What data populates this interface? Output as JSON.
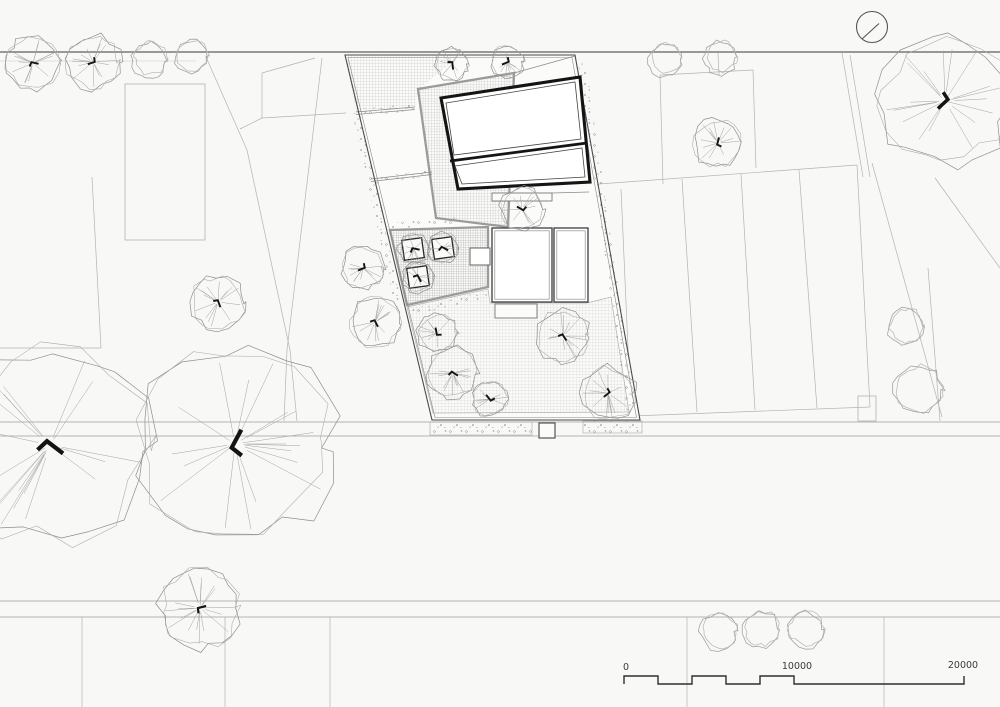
{
  "drawing": {
    "type": "architectural-site-plan"
  },
  "colors": {
    "background": "#f8f8f6",
    "road_dark": "#5f5f5f",
    "road_light": "#9f9f9f",
    "context_line": "#b3b3b3",
    "boundary": "#4a4a4a",
    "building_wall": "#141414",
    "gray_border": "#9b9b9b",
    "speckle": "#8c8c8c",
    "tree_outline": "#8f8f8f",
    "tree_spoke": "#a2a2a2",
    "trunk": "#141414",
    "scale": "#2f2f2f"
  },
  "roads": [
    [
      0,
      52,
      1000,
      52,
      1.3,
      "#5f5f5f"
    ],
    [
      0,
      61,
      196,
      61,
      0.6,
      "#c6c6c6"
    ],
    [
      0,
      422,
      1000,
      422,
      0.8,
      "#9f9f9f"
    ],
    [
      0,
      436,
      1000,
      436,
      0.8,
      "#9f9f9f"
    ],
    [
      0,
      601,
      1000,
      601,
      0.8,
      "#9f9f9f"
    ],
    [
      0,
      617,
      1000,
      617,
      0.8,
      "#9f9f9f"
    ]
  ],
  "context": {
    "rects": [
      [
        125,
        84,
        80,
        156
      ],
      [
        858,
        396,
        18,
        25
      ]
    ],
    "segments": [
      [
        315,
        58,
        262,
        73
      ],
      [
        262,
        73,
        262,
        118
      ],
      [
        262,
        118,
        240,
        129
      ],
      [
        262,
        118,
        346,
        113
      ],
      [
        206,
        57,
        247,
        150
      ],
      [
        247,
        150,
        290,
        350
      ],
      [
        290,
        350,
        297,
        421
      ],
      [
        322,
        58,
        287,
        350
      ],
      [
        287,
        350,
        284,
        421
      ],
      [
        92,
        177,
        101,
        348
      ],
      [
        0,
        348,
        101,
        348
      ],
      [
        82,
        617,
        82,
        707
      ],
      [
        225,
        617,
        225,
        707
      ],
      [
        330,
        617,
        330,
        707
      ],
      [
        687,
        617,
        687,
        707
      ],
      [
        884,
        617,
        884,
        707
      ],
      [
        599,
        184,
        857,
        165
      ],
      [
        857,
        165,
        870,
        407
      ],
      [
        631,
        416,
        870,
        407
      ],
      [
        621,
        189,
        631,
        416
      ],
      [
        682,
        179,
        697,
        412
      ],
      [
        741,
        174,
        755,
        410
      ],
      [
        799,
        170,
        817,
        408
      ],
      [
        660,
        75,
        753,
        70
      ],
      [
        660,
        75,
        663,
        184
      ],
      [
        753,
        70,
        756,
        168
      ],
      [
        718,
        53,
        719,
        75
      ],
      [
        872,
        163,
        942,
        417
      ],
      [
        928,
        268,
        940,
        421
      ],
      [
        935,
        178,
        1000,
        268
      ],
      [
        842,
        53,
        863,
        177
      ],
      [
        850,
        55,
        870,
        177
      ]
    ]
  },
  "site": {
    "boundary": [
      [
        345,
        55
      ],
      [
        575,
        55
      ],
      [
        640,
        420
      ],
      [
        432,
        420
      ]
    ],
    "regions": {
      "top_hatch": [
        [
          345,
          55
        ],
        [
          460,
          55
        ],
        [
          419,
          89
        ],
        [
          414,
          108
        ],
        [
          356,
          112
        ]
      ],
      "terrace": [
        [
          418,
          89
        ],
        [
          514,
          73
        ],
        [
          508,
          227
        ],
        [
          436,
          218
        ]
      ],
      "courtyard": [
        [
          390,
          230
        ],
        [
          488,
          227
        ],
        [
          488,
          287
        ],
        [
          407,
          305
        ]
      ],
      "garden": [
        [
          407,
          307
        ],
        [
          488,
          289
        ],
        [
          490,
          303
        ],
        [
          587,
          303
        ],
        [
          611,
          297
        ],
        [
          629,
          412
        ],
        [
          433,
          413
        ]
      ]
    },
    "division_lines": [
      [
        356,
        112,
        415,
        107
      ],
      [
        356,
        114.5,
        415,
        109.5
      ],
      [
        371,
        179,
        432,
        172
      ],
      [
        371,
        181.5,
        432,
        174.5
      ],
      [
        514,
        73,
        575,
        56
      ],
      [
        552,
        193,
        589,
        192
      ]
    ],
    "speckle_bands": [
      [
        [
          352,
          113
        ],
        [
          360,
          113
        ],
        [
          402,
          306
        ],
        [
          395,
          307
        ]
      ],
      [
        [
          578,
          63
        ],
        [
          586,
          63
        ],
        [
          636,
          413
        ],
        [
          627,
          413
        ]
      ],
      [
        [
          356,
          109
        ],
        [
          414,
          104
        ],
        [
          415,
          111
        ],
        [
          357,
          116
        ]
      ],
      [
        [
          371,
          177
        ],
        [
          432,
          170
        ],
        [
          433,
          176
        ],
        [
          372,
          184
        ]
      ],
      [
        [
          391,
          223
        ],
        [
          458,
          217
        ],
        [
          458,
          223
        ],
        [
          391,
          229
        ]
      ],
      [
        [
          409,
          309
        ],
        [
          488,
          291
        ],
        [
          489,
          297
        ],
        [
          410,
          316
        ]
      ]
    ],
    "road_strip": {
      "beds": [
        [
          430,
          422,
          102,
          13
        ],
        [
          583,
          421,
          59,
          12
        ]
      ],
      "gate": [
        539,
        423,
        16,
        15
      ]
    }
  },
  "buildings": {
    "main": {
      "outer": [
        [
          441,
          98
        ],
        [
          580,
          77
        ],
        [
          590,
          182
        ],
        [
          458,
          189
        ]
      ],
      "divider": [
        450,
        161,
        587,
        143
      ],
      "inner": [
        [
          [
            446,
            103
          ],
          [
            575,
            82
          ],
          [
            581,
            139
          ],
          [
            454,
            155
          ]
        ],
        [
          [
            455,
            166
          ],
          [
            582,
            148
          ],
          [
            585,
            177
          ],
          [
            462,
            184
          ]
        ]
      ]
    },
    "annex": [
      [
        492,
        228,
        60,
        74
      ],
      [
        554,
        228,
        34,
        74
      ]
    ],
    "steps": [
      [
        492,
        193,
        60,
        8
      ],
      [
        495,
        304,
        42,
        14
      ]
    ],
    "planters": {
      "size": 20,
      "rotation": -8,
      "centers": [
        [
          413,
          249
        ],
        [
          443,
          248
        ],
        [
          418,
          277
        ]
      ]
    },
    "store": [
      470,
      248,
      20,
      17
    ]
  },
  "trees": {
    "detailed": [
      [
        33,
        63,
        28
      ],
      [
        93,
        62,
        28
      ],
      [
        452,
        64,
        17
      ],
      [
        507,
        62,
        17
      ],
      [
        718,
        143,
        25
      ],
      [
        945,
        101,
        66
      ],
      [
        218,
        302,
        28
      ],
      [
        363,
        268,
        22
      ],
      [
        375,
        322,
        26
      ],
      [
        522,
        209,
        22
      ],
      [
        437,
        333,
        20
      ],
      [
        453,
        373,
        26
      ],
      [
        490,
        399,
        18
      ],
      [
        563,
        336,
        27
      ],
      [
        608,
        393,
        28
      ],
      [
        414,
        249,
        16
      ],
      [
        443,
        248,
        16
      ],
      [
        418,
        277,
        16
      ],
      [
        50,
        445,
        102
      ],
      [
        235,
        444,
        102
      ],
      [
        200,
        608,
        41
      ]
    ],
    "simple": [
      [
        149,
        60,
        18
      ],
      [
        191,
        57,
        17
      ],
      [
        665,
        60,
        17
      ],
      [
        720,
        58,
        17
      ],
      [
        905,
        327,
        19
      ],
      [
        918,
        390,
        25
      ],
      [
        718,
        632,
        19
      ],
      [
        761,
        630,
        19
      ],
      [
        805,
        630,
        19
      ]
    ]
  },
  "north_symbol": {
    "cx": 872,
    "cy": 27,
    "r": 15.5,
    "needle": [
      879,
      23.5,
      862,
      39
    ]
  },
  "scale_bar": {
    "labels": [
      "0",
      "10000",
      "20000"
    ],
    "path": "M624,684 V676 H658 V684 H692 V676 H726 V684 H760 V676 H794 V684 H964 V676"
  }
}
